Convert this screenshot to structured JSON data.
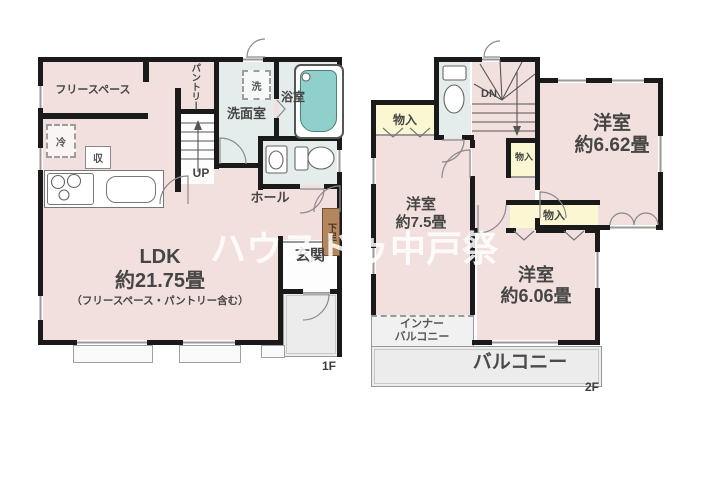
{
  "watermark_text": "ハウスドゥ中戸祭",
  "floor1": {
    "floor_label": "1F",
    "free_space_label": "フリースペース",
    "pantry_label": "パントリー",
    "washer_label": "洗",
    "bathroom_label": "浴室",
    "washroom_label": "洗面室",
    "fridge_label": "冷",
    "storage_label": "収",
    "stairs_label": "UP",
    "hall_label": "ホール",
    "shoe_cabinet_label": "下足",
    "entrance_label": "玄関",
    "ldk_title": "LDK",
    "ldk_size": "約21.75畳",
    "ldk_note": "（フリースペース・パントリー含む）"
  },
  "floor2": {
    "floor_label": "2F",
    "closet_nw_label": "物入",
    "closet_mid_label": "物入",
    "closet_s_label": "物入",
    "stairs_label": "DN",
    "room_ne_title": "洋室",
    "room_ne_size": "約6.62畳",
    "room_w_title": "洋室",
    "room_w_size": "約7.5畳",
    "room_s_title": "洋室",
    "room_s_size": "約6.06畳",
    "inner_balcony_label": "インナー\nバルコニー",
    "balcony_label": "バルコニー"
  },
  "colors": {
    "wall": "#1a1a1a",
    "room_pink": "#f2e0de",
    "wet_area": "#e4edeb",
    "closet_yellow": "#faf7d2",
    "bathtub_teal": "#8fd0cc",
    "shoe_cabinet_brown": "#b3875d",
    "outdoor_gray": "#ececec",
    "label_text": "#454545"
  }
}
